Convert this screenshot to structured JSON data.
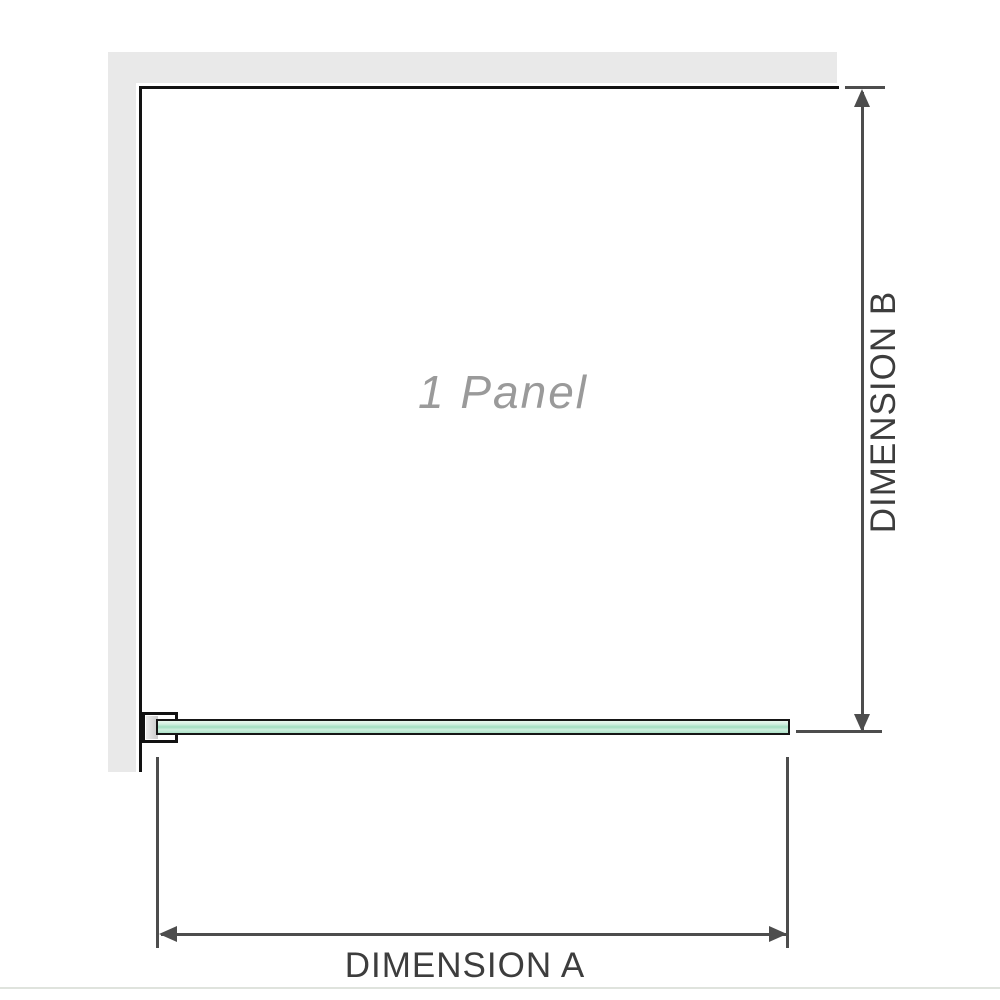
{
  "diagram": {
    "type": "shower-screen-dimension-diagram",
    "panel_label": "1 Panel",
    "dimension_a_label": "DIMENSION A",
    "dimension_b_label": "DIMENSION B"
  },
  "colors": {
    "wall": "#e9e9e9",
    "wall_edge": "#121212",
    "glass_fill": "#a2dec1",
    "glass_border": "#161616",
    "dimension_arrow": "#4d4d4d",
    "label_text": "#3d3d3d",
    "panel_text": "#9a9a9a",
    "bottom_rule": "#dfe3dd"
  }
}
